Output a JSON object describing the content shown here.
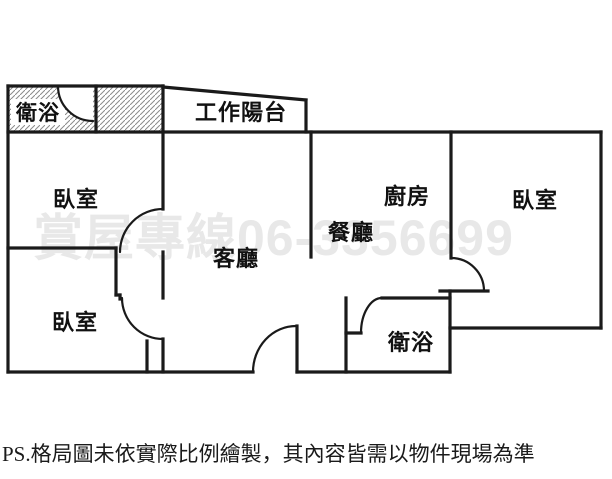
{
  "floorplan": {
    "rooms": {
      "bathroom_top_left": "衛浴",
      "work_balcony": "工作陽台",
      "bedroom_top_left": "臥室",
      "bedroom_bottom_left": "臥室",
      "living_room": "客廳",
      "dining_room": "餐廳",
      "kitchen": "廚房",
      "bedroom_right": "臥室",
      "bathroom_bottom": "衛浴"
    },
    "watermark": "賞屋專線06-3356699",
    "disclaimer": "PS.格局圖未依實際比例繪製，其內容皆需以物件現場為準",
    "colors": {
      "wall": "#1a1a1a",
      "hatch_line": "#8a8a8a",
      "watermark": "#e8e8e8",
      "label_text": "#111111",
      "disclaimer_text": "#1a1a1a",
      "background": "#ffffff"
    }
  }
}
